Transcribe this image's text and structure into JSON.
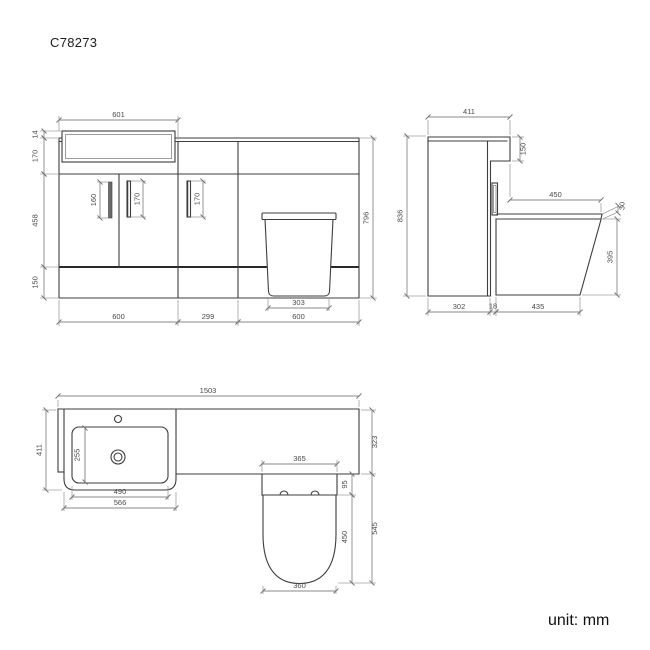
{
  "title": "C78273",
  "unit_label": "unit: mm",
  "front_view": {
    "basin_width": "601",
    "basin_overhang": "14",
    "worktop_band_height": "170",
    "door_height": "458",
    "plinth_height": "150",
    "overall_height": "796",
    "vanity_width": "600",
    "mid_unit_width": "299",
    "wc_unit_width": "600",
    "pan_base_width": "303",
    "handle_left_length": "160",
    "handle_mid_length": "170",
    "handle_right_length": "170"
  },
  "side_view": {
    "worktop_depth": "411",
    "worktop_drop": "150",
    "overall_height": "836",
    "seat_depth": "450",
    "seat_thickness": "30",
    "pan_height": "395",
    "cabinet_depth": "302",
    "gap": "18",
    "pan_depth": "435"
  },
  "plan_view": {
    "overall_width": "1503",
    "left_depth": "411",
    "bowl_inner_depth": "255",
    "bowl_width": "490",
    "basin_unit_width": "566",
    "worktop_depth": "323",
    "recess_width": "365",
    "seat_setback": "95",
    "seat_length": "450",
    "overall_depth": "545",
    "seat_width": "360"
  }
}
